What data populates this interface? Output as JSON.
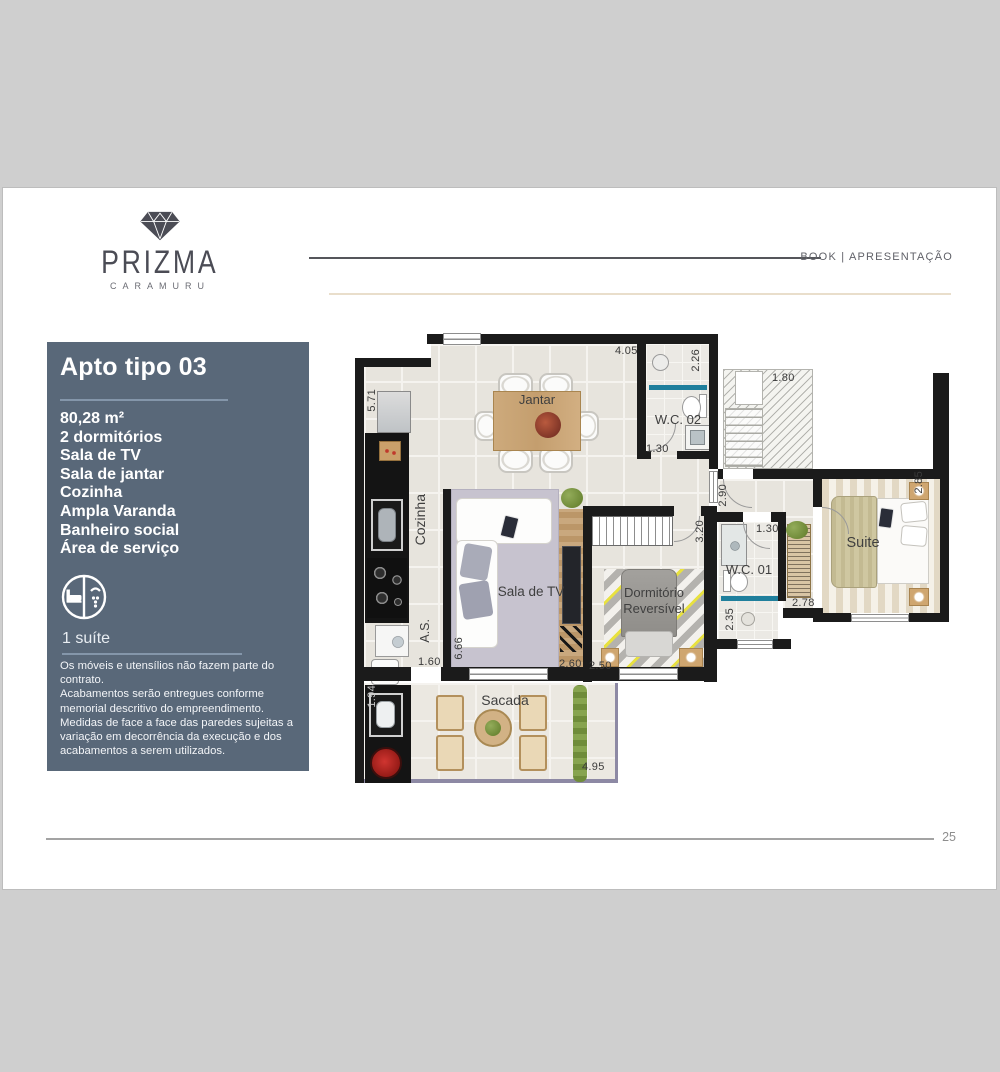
{
  "header": {
    "brand_name": "PRIZMA",
    "brand_subtitle": "CARAMURU",
    "section_label": "BOOK | APRESENTAÇÃO"
  },
  "sidebar": {
    "title": "Apto tipo 03",
    "specs": [
      "80,28 m²",
      "2 dormitórios",
      "Sala de TV",
      "Sala de jantar",
      "Cozinha",
      "Ampla Varanda",
      "Banheiro social",
      "Área de serviço"
    ],
    "suite_note": "1 suíte",
    "disclaimer": [
      "Os móveis e utensílios não fazem parte do contrato.",
      "Acabamentos serão entregues conforme memorial descritivo do empreendimento.",
      "Medidas de face a face das paredes sujeitas a variação em decorrência da execução e dos acabamentos a serem utilizados."
    ]
  },
  "floorplan": {
    "rooms": {
      "jantar": "Jantar",
      "cozinha": "Cozinha",
      "wc02": "W.C. 02",
      "sala": "Sala de TV",
      "dorm_line1": "Dormitório",
      "dorm_line2": "Reversível",
      "wc01": "W.C. 01",
      "suite": "Suite",
      "as": "A.S.",
      "sacada": "Sacada"
    },
    "measurements": {
      "jantar_w": "4.05",
      "wc02_d": "2.26",
      "hall": "1.80",
      "wc02_w": "1.30",
      "cozinha_l": "5.71",
      "corridor": "2.90",
      "dorm_d": "3.20",
      "wc01_w": "1.30",
      "suite_d": "2.85",
      "closet": "2.78",
      "shower_d": "2.35",
      "sala_d": "6.66",
      "as_w": "1.60",
      "sala_w": "2.60",
      "dorm_w": "2.50",
      "sacada_l": "1.94",
      "sacada_w": "4.95"
    }
  },
  "footer": {
    "page_number": "25"
  },
  "colors": {
    "sidebar_bg": "#596879",
    "wall": "#1b1b1b",
    "accent_teal": "#1f7f9c",
    "beige_line": "#e9decb"
  }
}
